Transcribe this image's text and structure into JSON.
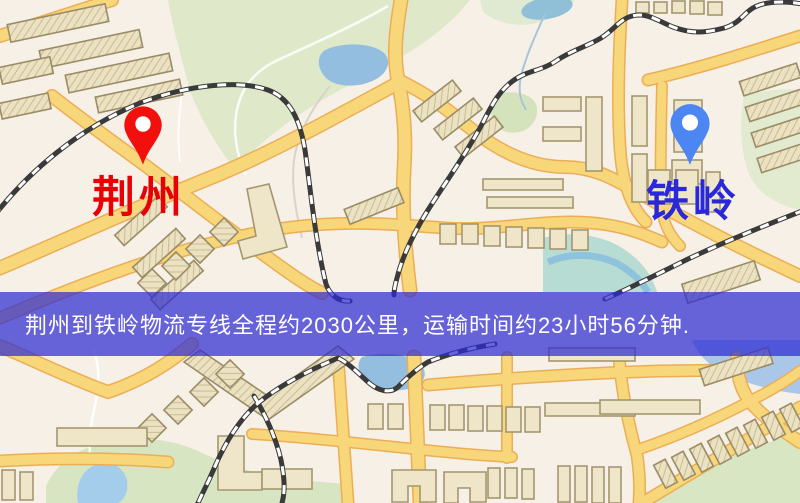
{
  "map": {
    "origin": {
      "label": "荆州",
      "pin_color": "#f2100d",
      "label_color": "#e80005"
    },
    "destination": {
      "label": "铁岭",
      "pin_color": "#4b86f2",
      "label_color": "#2b28d8"
    },
    "banner": {
      "text": "荆州到铁岭物流专线全程约2030公里，运输时间约23小时56分钟.",
      "background": "rgba(46,43,210,0.72)",
      "text_color": "#ffffff"
    },
    "legend": {
      "road_color": "#f8d67a",
      "rail_color": "#3a3a3a",
      "water_color": "#93bedf",
      "park_color": "#dce8ca",
      "building_color": "#efe6ca"
    }
  }
}
